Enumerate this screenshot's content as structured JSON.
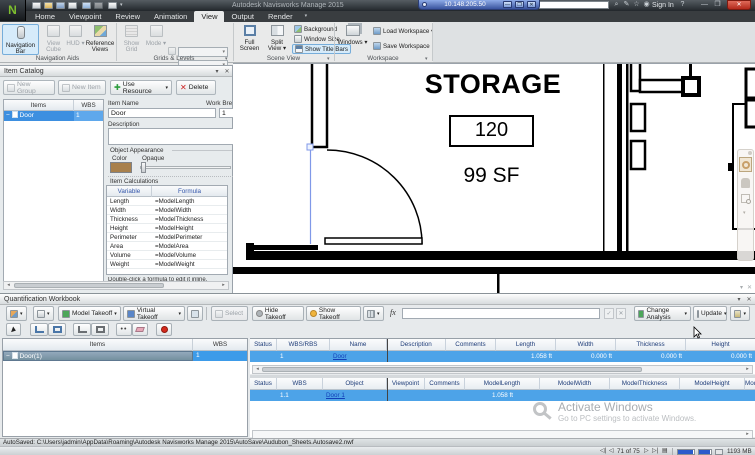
{
  "window": {
    "title": "Autodesk Navisworks Manage 2015",
    "rdp_address": "10.148.205.50",
    "sign_in_label": "Sign In"
  },
  "ribbon": {
    "tabs": [
      "Home",
      "Viewpoint",
      "Review",
      "Animation",
      "View",
      "Output",
      "Render"
    ],
    "navigation_bar": "Navigation Bar",
    "view_cube": "View Cube",
    "hud": "HUD",
    "reference_views": "Reference Views",
    "show_grid": "Show Grid",
    "mode": "Mode",
    "full_screen": "Full Screen",
    "split_view": "Split View",
    "background": "Background",
    "window_size": "Window Size",
    "show_title_bars": "Show Title Bars",
    "windows": "Windows",
    "load_workspace": "Load Workspace",
    "save_workspace": "Save Workspace",
    "groups": {
      "navigation_aids": "Navigation Aids",
      "grids_levels": "Grids & Levels",
      "scene_view": "Scene View",
      "workspace": "Workspace"
    }
  },
  "item_catalog": {
    "title": "Item Catalog",
    "new_group": "New Group",
    "new_item": "New Item",
    "use_resource": "Use Resource",
    "delete_label": "Delete",
    "columns": {
      "items": "Items",
      "wbs": "WBS"
    },
    "row": {
      "item": "Door",
      "wbs": "1"
    },
    "form": {
      "item_name_label": "Item Name",
      "item_name": "Door",
      "work_breakdown_label": "Work Breakdown",
      "work_breakdown": "1",
      "description_label": "Description",
      "description": "",
      "object_appearance_label": "Object Appearance",
      "color_label": "Color",
      "opaque_label": "Opaque",
      "color_hex": "#A8804C",
      "item_calculations_label": "Item Calculations",
      "calc_columns": {
        "variable": "Variable",
        "formula": "Formula"
      },
      "calc_rows": [
        {
          "v": "Length",
          "f": "=ModelLength"
        },
        {
          "v": "Width",
          "f": "=ModelWidth"
        },
        {
          "v": "Thickness",
          "f": "=ModelThickness"
        },
        {
          "v": "Height",
          "f": "=ModelHeight"
        },
        {
          "v": "Perimeter",
          "f": "=ModelPerimeter"
        },
        {
          "v": "Area",
          "f": "=ModelArea"
        },
        {
          "v": "Volume",
          "f": "=ModelVolume"
        },
        {
          "v": "Weight",
          "f": "=ModelWeight"
        }
      ],
      "hint": "Double-click a formula to edit it inline."
    }
  },
  "scene": {
    "room_name": "STORAGE",
    "room_number": "120",
    "room_area": "99 SF"
  },
  "workbook": {
    "title": "Quantification Workbook",
    "toolbar": {
      "model_takeoff": "Model Takeoff",
      "virtual_takeoff": "Virtual Takeoff",
      "select_label": "Select",
      "hide_takeoff": "Hide Takeoff",
      "show_takeoff": "Show Takeoff",
      "fx_label": "fx",
      "change_analysis": "Change Analysis",
      "update_label": "Update"
    },
    "tree": {
      "items_col": "Items",
      "wbs_col": "WBS",
      "row": {
        "item": "Door(1)",
        "wbs": "1"
      }
    },
    "item_grid": {
      "columns": [
        "Status",
        "WBS/RBS",
        "Name",
        "Description",
        "Comments",
        "Length",
        "Width",
        "Thickness",
        "Height"
      ],
      "row": {
        "wbs": "1",
        "name": "Door",
        "length": "1.058 ft",
        "width": "0.000 ft",
        "thickness": "0.000 ft",
        "height": "0.000 ft"
      }
    },
    "object_grid": {
      "columns": [
        "Status",
        "WBS",
        "Object",
        "Viewpoint",
        "Comments",
        "ModelLength",
        "ModelWidth",
        "ModelThickness",
        "ModelHeight",
        "ModelPerimeter"
      ],
      "row": {
        "wbs": "1.1",
        "object": "Door 1",
        "model_length": "1.058 ft"
      }
    }
  },
  "watermark": {
    "line1": "Activate Windows",
    "line2": "Go to PC settings to activate Windows."
  },
  "status": {
    "autosave": "AutoSaved: C:\\Users\\jadmin\\AppData\\Roaming\\Autodesk Navisworks Manage 2015\\AutoSave\\Audubon_Sheets.Autosave2.nwf",
    "sheet_position": "71 of 75",
    "memory": "1193 MB"
  }
}
